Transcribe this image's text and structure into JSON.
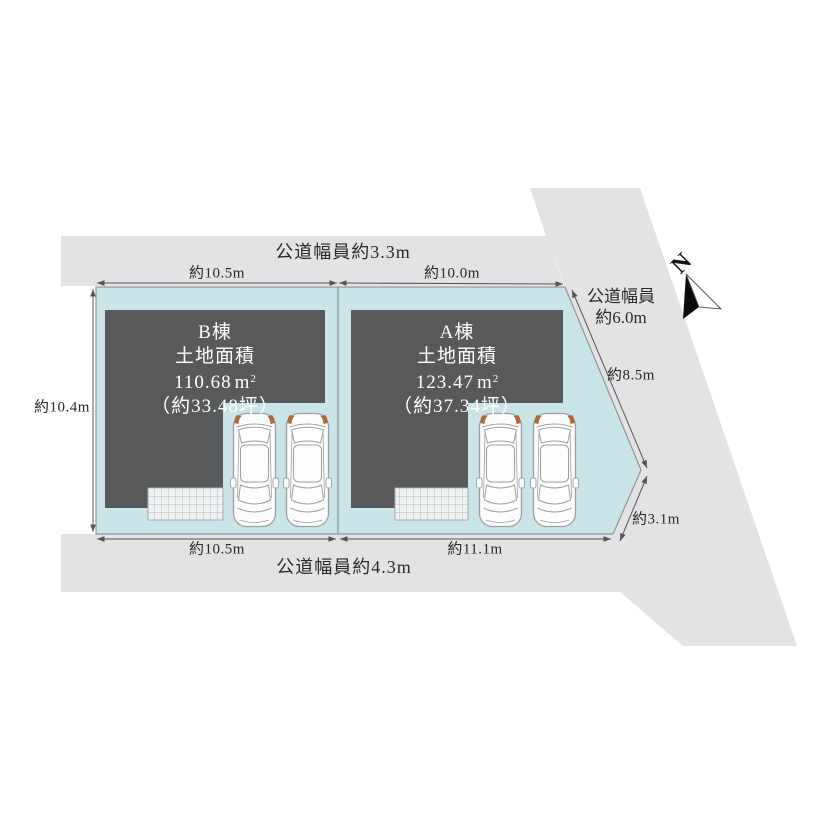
{
  "page": {
    "background": "#ffffff"
  },
  "colors": {
    "road": "#e3e3e5",
    "lot_fill": "#cae5e8",
    "lot_stroke": "#8f979a",
    "building": "#58595b",
    "building_text": "#ffffff",
    "dim_line": "#555555",
    "hatch_fill": "#eef1f1",
    "hatch_line": "#b5babc",
    "car_body": "#fdfdfd",
    "car_outline": "#9aa0a4",
    "car_accent": "#b0673a"
  },
  "roads": {
    "top": {
      "label": "公道幅員約3.3m"
    },
    "right": {
      "label_line1": "公道幅員",
      "label_line2": "約6.0m"
    },
    "bottom": {
      "label": "公道幅員約4.3m"
    }
  },
  "dimensions": {
    "top_b": "約10.5m",
    "top_a": "約10.0m",
    "left_b": "約10.4m",
    "bottom_b": "約10.5m",
    "bottom_a": "約11.1m",
    "right_upper": "約8.5m",
    "right_lower": "約3.1m"
  },
  "lots": {
    "b": {
      "name": "B棟",
      "area_title": "土地面積",
      "area_value": "110.68",
      "area_unit": "m",
      "area_unit_sup": "2",
      "area_tsubo": "（約33.48坪）"
    },
    "a": {
      "name": "A棟",
      "area_title": "土地面積",
      "area_value": "123.47",
      "area_unit": "m",
      "area_unit_sup": "2",
      "area_tsubo": "（約37.34坪）"
    }
  },
  "compass": {
    "north_label": "N"
  }
}
